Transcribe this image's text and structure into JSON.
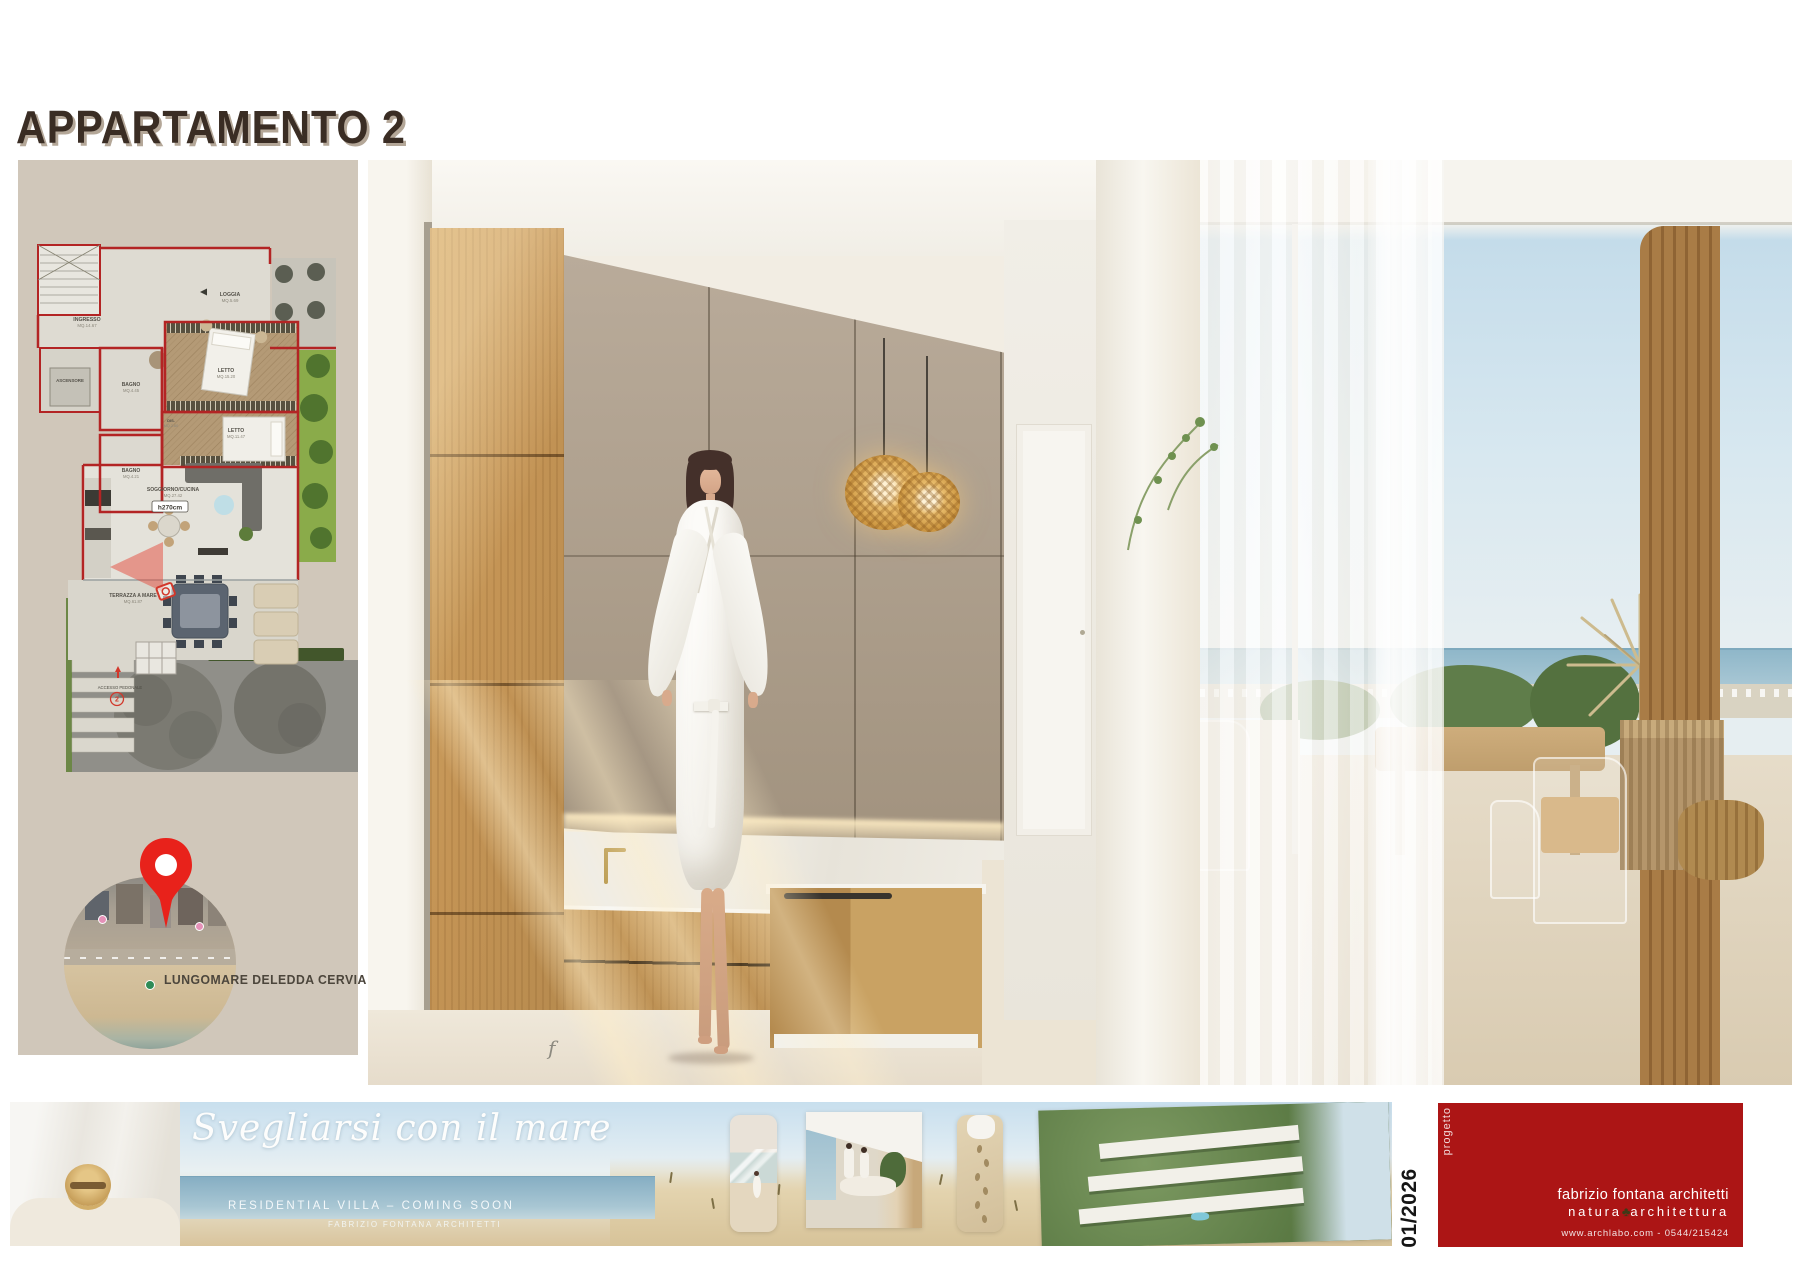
{
  "title": "APPARTAMENTO 2",
  "floorplan": {
    "rooms": {
      "ingresso": {
        "name": "INGRESSO",
        "area": "MQ.14.67"
      },
      "loggia": {
        "name": "LOGGIA",
        "area": "MQ.5.69"
      },
      "ascensore": {
        "name": "ASCENSORE"
      },
      "bagno1": {
        "name": "BAGNO",
        "area": "MQ.4.45"
      },
      "letto1": {
        "name": "LETTO",
        "area": "MQ.15.20"
      },
      "dis": {
        "name": "DIS.",
        "area": "MQ.2.60"
      },
      "bagno2": {
        "name": "BAGNO",
        "area": "MQ.4.21"
      },
      "letto2": {
        "name": "LETTO",
        "area": "MQ.11.47"
      },
      "soggiorno": {
        "name": "SOGGIORNO/CUCINA",
        "area": "MQ.27.42"
      },
      "terrazza": {
        "name": "TERRAZZA A MARE",
        "area": "MQ.61.87"
      }
    },
    "ceiling_height": "h270cm",
    "access": "ACCESSO PEDONALE",
    "unit_number": "2"
  },
  "map": {
    "caption": "LUNGOMARE DELEDDA CERVIA"
  },
  "banner": {
    "headline": "Svegliarsi con il mare",
    "subheadline": "RESIDENTIAL VILLA – COMING SOON",
    "credit": "FABRIZIO FONTANA ARCHITETTI",
    "watermark": "f"
  },
  "footer": {
    "issue_label": "progetto",
    "date": "01/2026",
    "studio": "fabrizio fontana architetti",
    "tagline_left": "natura",
    "tagline_right": "architettura",
    "tree_icon": "♣",
    "contact": "www.archlabo.com - 0544/215424"
  },
  "colors": {
    "accent_red": "#ac1515",
    "plan_wall_red": "#b32424",
    "pin_red": "#e8221b",
    "panel_beige": "#d0c7ba",
    "title_brown": "#3a2d24"
  }
}
